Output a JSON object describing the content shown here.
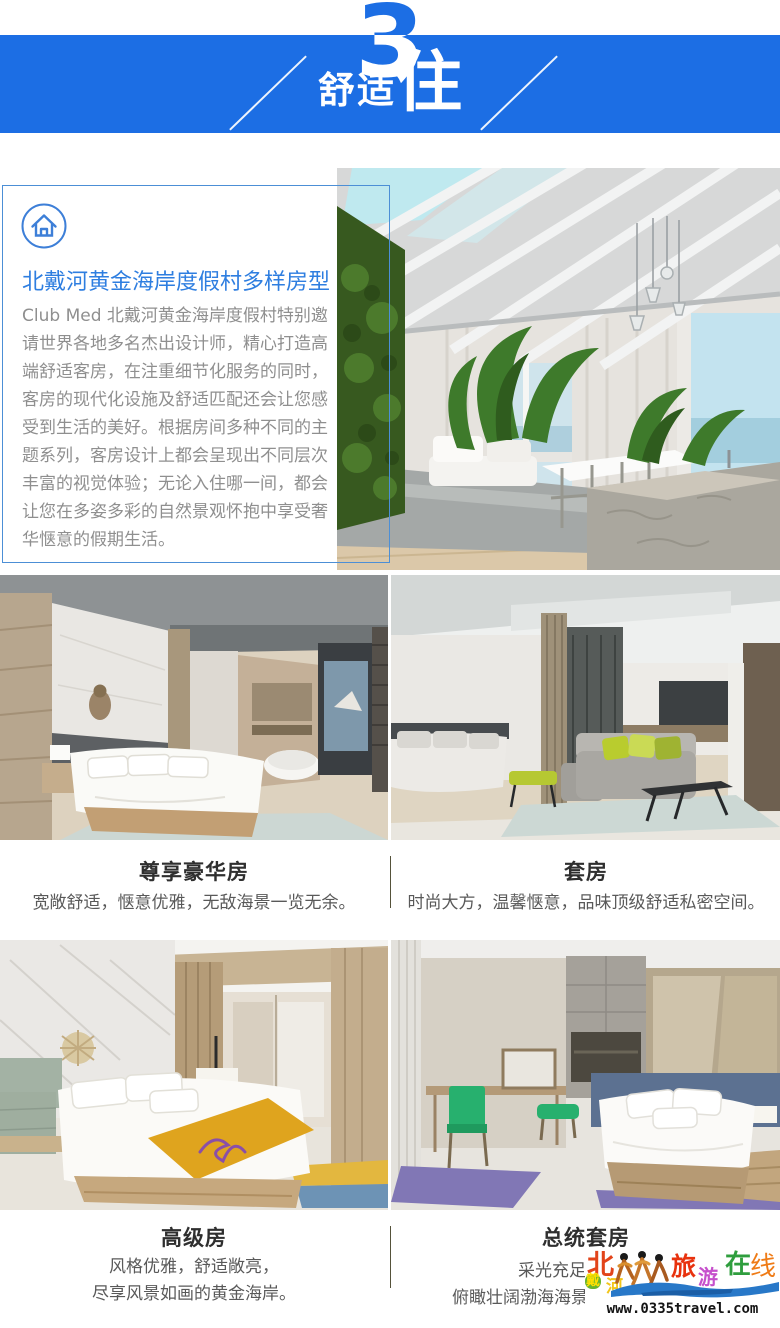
{
  "meta": {
    "accent_blue": "#1c6ee4",
    "title_blue": "#2e7ee0",
    "box_border_blue": "#4c8fd6",
    "divider_olive": "#55523a",
    "paragraph_gray": "#8f8f8f"
  },
  "header": {
    "number": "3",
    "title_small": "舒适",
    "title_big": "住"
  },
  "intro": {
    "icon": "home-icon",
    "title": "北戴河黄金海岸度假村多样房型",
    "paragraph": "Club Med 北戴河黄金海岸度假村特别邀请世界各地多名杰出设计师，精心打造高端舒适客房，在注重细节化服务的同时，客房的现代化设施及舒适匹配还会让您感受到生活的美好。根据房间多种不同的主题系列，客房设计上都会呈现出不同层次丰富的视觉体验；无论入住哪一间，都会让您在多姿多彩的自然景观怀抱中享受奢华惬意的假期生活。",
    "photo": "resort-living-room"
  },
  "rooms": [
    {
      "name": "尊享豪华房",
      "desc1": "宽敞舒适，惬意优雅，无敌海景一览无余。",
      "photo": "deluxe-room"
    },
    {
      "name": "套房",
      "desc1": "时尚大方，温馨惬意，品味顶级舒适私密空间。",
      "photo": "suite-room"
    },
    {
      "name": "高级房",
      "desc1": "风格优雅，舒适敞亮，",
      "desc2": "尽享风景如画的黄金海岸。",
      "photo": "superior-room"
    },
    {
      "name": "总统套房",
      "desc1": "采光充足",
      "desc2": "俯瞰壮阔渤海海景",
      "photo": "presidential-suite"
    }
  ],
  "watermark": {
    "chars": [
      {
        "t": "北",
        "c": "#e2441a"
      },
      {
        "t": "戴",
        "c": "#ffdf00"
      },
      {
        "t": "河",
        "c": "#f2c51a"
      },
      {
        "t": "旅",
        "c": "#e8320e"
      },
      {
        "t": "游",
        "c": "#c650cc"
      },
      {
        "t": "在",
        "c": "#2f9e3e"
      },
      {
        "t": "线",
        "c": "#ef7b16"
      }
    ],
    "wave_blue": "#2878c8",
    "url": "www.0335travel.com"
  }
}
